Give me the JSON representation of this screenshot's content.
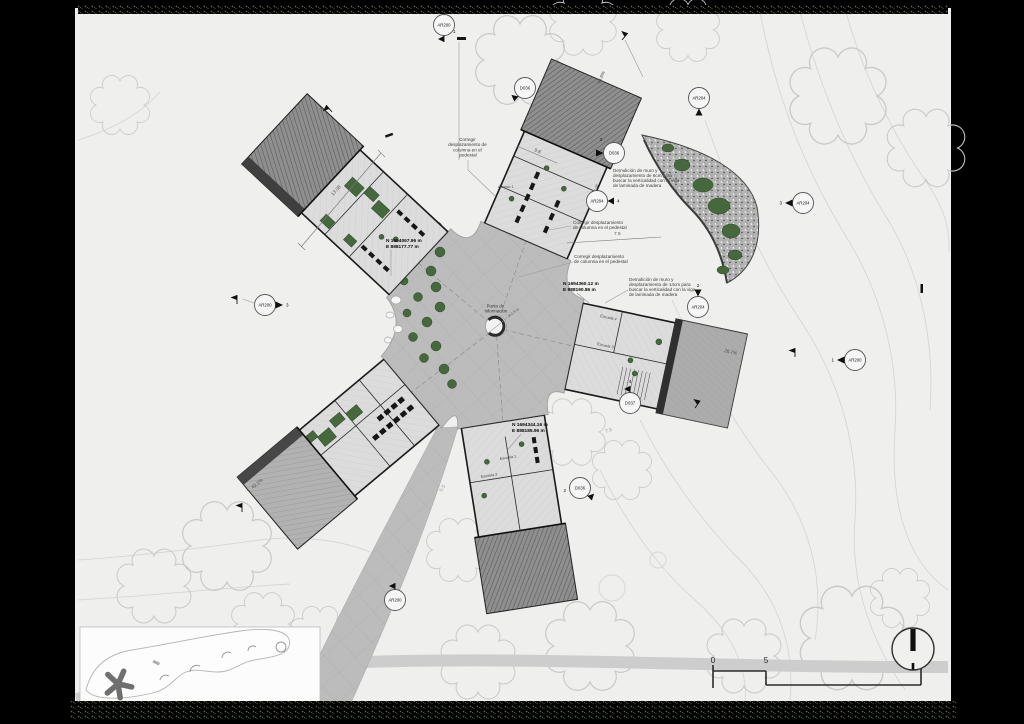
{
  "annotations": {
    "corregir1": {
      "l1": "Corregir",
      "l2": "desplazamiento de",
      "l3": "columna en el",
      "l4": "pedestal"
    },
    "demolicion6": {
      "l1": "Demolición de muro y",
      "l2": "desplazamiento de 6cm para",
      "l3": "buscar la verticalidad con la viga",
      "l4": "de laminada de madera"
    },
    "corregir2": {
      "l1": "Corregir desplazamiento",
      "l2": "de columna en el pedestal"
    },
    "corregir3": {
      "l1": "Corregir desplazamiento",
      "l2": "de columna en el pedestal"
    },
    "demolicion14": {
      "l1": "Demolición de muro y",
      "l2": "desplazamiento de 14cm para",
      "l3": "buscar la verticalidad con la viga",
      "l4": "de laminada de madera"
    }
  },
  "coordinates": {
    "nw": {
      "n": "N 1694067.96 m",
      "e": "E 888177.77 m"
    },
    "east": {
      "n": "N 1694360.12 m",
      "e": "E 888190.86 m"
    },
    "south": {
      "n": "N 1694344.16 m",
      "e": "E 888185.96 m"
    }
  },
  "info_point": {
    "l1": "Punto de",
    "l2": "información",
    "diameter": "ø 2.9 m"
  },
  "slopes": {
    "sw": "42.1%",
    "east": "26.7%",
    "north": "26.6%"
  },
  "dimensions": {
    "n_wing": "9.8",
    "crescent": "7.5",
    "nw_wing": "13.08",
    "mouth_a": "7.08",
    "mouth_b": "6.1"
  },
  "contour_labels": {
    "a": "7.5",
    "b": "5.5"
  },
  "rooms": {
    "s1": "Escuela 1",
    "s2": "Escuela 2",
    "e1": "Escuela 4",
    "e2": "Escuela 3",
    "acceso": "Acceso 1"
  },
  "callouts": [
    {
      "label": "AR200",
      "num": ""
    },
    {
      "label": "D036",
      "num": ""
    },
    {
      "label": "AR204",
      "num": ""
    },
    {
      "label": "D036",
      "num": "3"
    },
    {
      "label": "AR204",
      "num": "4"
    },
    {
      "label": "AR204",
      "num": "3"
    },
    {
      "label": "AR204",
      "num": "2"
    },
    {
      "label": "AR200",
      "num": "1"
    },
    {
      "label": "D037",
      "num": "4"
    },
    {
      "label": "D036",
      "num": "2"
    },
    {
      "label": "AR200",
      "num": "3"
    },
    {
      "label": "AR200",
      "num": ""
    }
  ],
  "benchmarks": {
    "b1": "1"
  },
  "scale_bar": {
    "t0": "0",
    "t1": "5",
    "t2": "20"
  },
  "colors": {
    "paper": "#efefee",
    "plaza": "#bcbcbc",
    "roof_dark": "#8a8a8a",
    "planting": "#45683d"
  }
}
